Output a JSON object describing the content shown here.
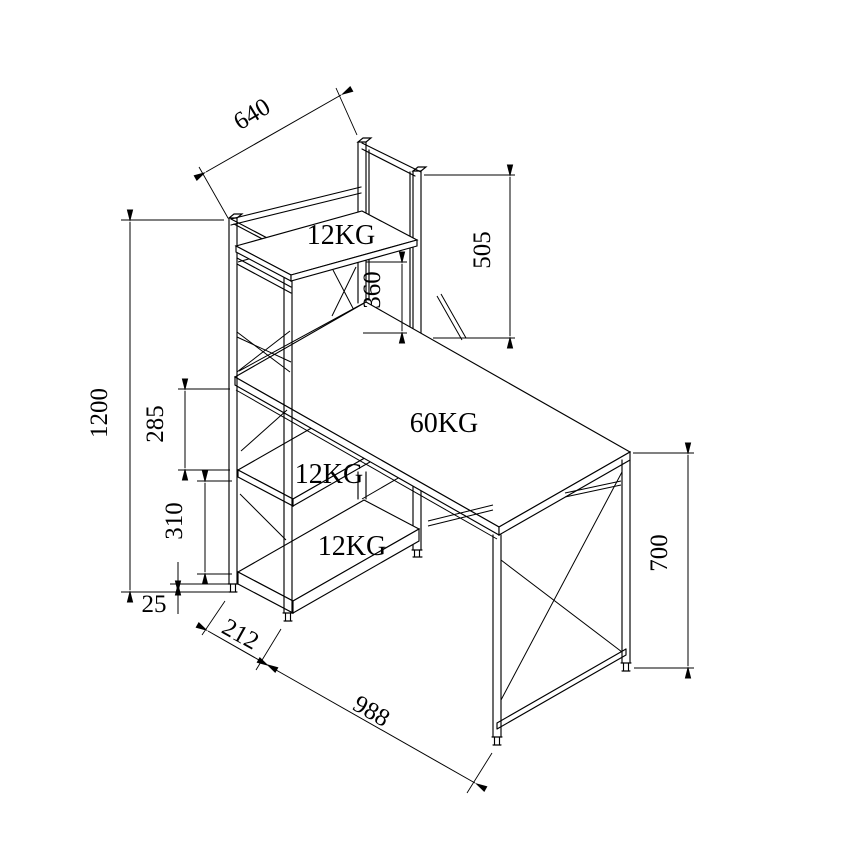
{
  "diagram": {
    "type": "furniture-technical-drawing",
    "background_color": "#ffffff",
    "line_color": "#000000",
    "dimensions": {
      "shelf_width_mm": "640",
      "hutch_frame_height_mm": "505",
      "hutch_clearance_mm": "360",
      "overall_height_mm": "1200",
      "upper_shelf_gap_mm": "285",
      "lower_shelf_gap_mm": "310",
      "foot_height_mm": "25",
      "tower_depth_mm": "212",
      "desk_length_mm": "988",
      "desk_height_mm": "700"
    },
    "load_capacities": {
      "top_shelf": "12KG",
      "desktop": "60KG",
      "middle_shelf": "12KG",
      "bottom_shelf": "12KG"
    }
  }
}
